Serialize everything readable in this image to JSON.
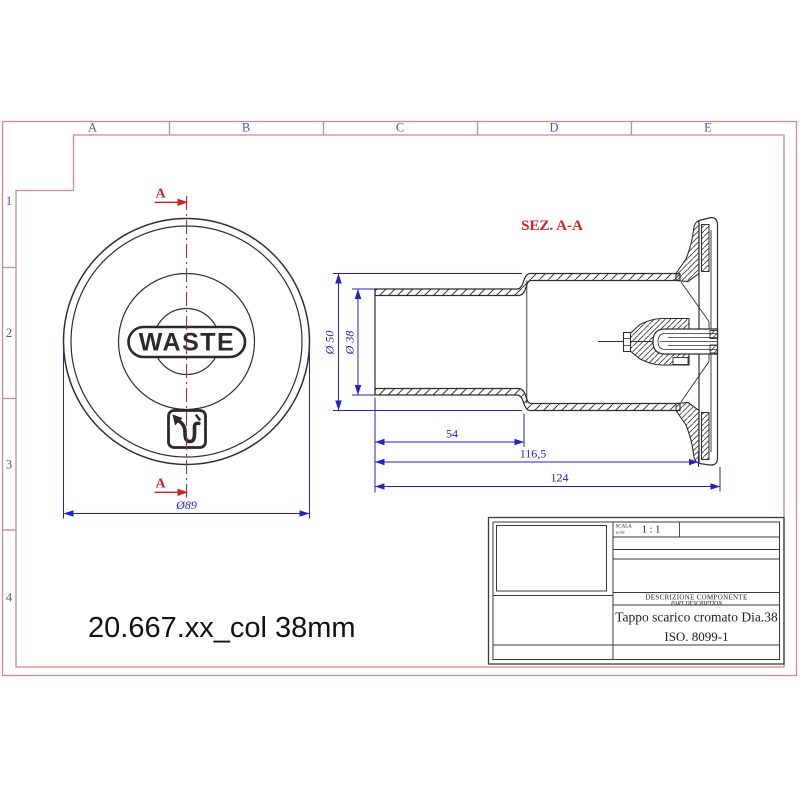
{
  "sheet": {
    "columns": [
      "A",
      "B",
      "C",
      "D",
      "E"
    ],
    "rows": [
      "1",
      "2",
      "3",
      "4"
    ]
  },
  "front_view": {
    "waste_label": "WASTE",
    "diameter_dim": "Ø89",
    "section_letter_top": "A",
    "section_letter_bottom": "A"
  },
  "section_view": {
    "title": "SEZ. A-A",
    "dim_outer_diameter": "Ø 50",
    "dim_inner_diameter": "Ø 38",
    "dim_length_short": "54",
    "dim_length_mid": "116,5",
    "dim_length_total": "124"
  },
  "drawing_title": "20.667.xx_col 38mm",
  "title_block": {
    "scale_label": "SCALA",
    "scale_label_en": "scale",
    "scale_value": "1 : 1",
    "description_label": "DESCRIZIONE COMPONENTE",
    "description_label_en": "PART DESCRIPTION",
    "component_name": "Tappo scarico cromato Dia.38",
    "standard": "ISO. 8099-1"
  },
  "colors": {
    "frame_pink": "#c98b8b",
    "label_blue": "#5353b0",
    "dimension_blue": "#2323c0",
    "section_red": "#cc2222",
    "ink": "#2e2e2e"
  }
}
